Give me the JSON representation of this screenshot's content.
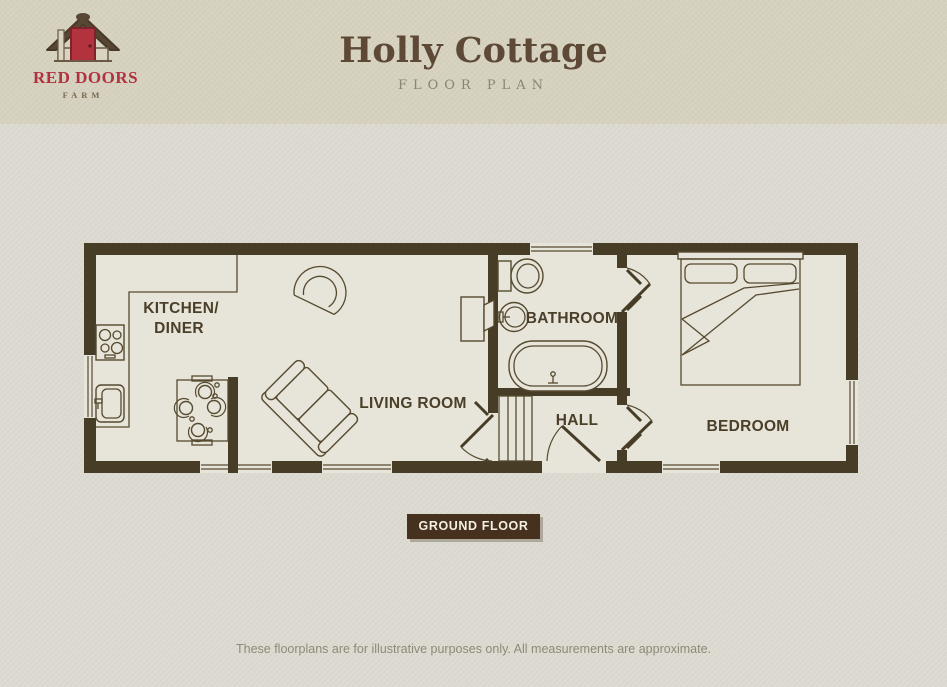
{
  "page": {
    "background": "#dcdad1"
  },
  "header": {
    "background": "#d6d2bf",
    "logo": {
      "icon": "red-door-hut-icon",
      "title": "RED DOORS",
      "subtitle": "FARM",
      "accent_red": "#b13140",
      "roof_brown": "#574633"
    },
    "title": "Holly Cottage",
    "subtitle": "FLOOR PLAN",
    "title_color": "#5e4936",
    "subtitle_color": "#8b8471"
  },
  "plan": {
    "wall_color": "#473d27",
    "room_fill": "#e7e4d9",
    "line_color": "#564a30",
    "labels": {
      "kitchen_line1": "KITCHEN/",
      "kitchen_line2": "DINER",
      "living": "LIVING ROOM",
      "bathroom": "BATHROOM",
      "hall": "HALL",
      "bedroom": "BEDROOM"
    },
    "fixtures": [
      "hob-icon",
      "kitchen-sink-icon",
      "kitchen-counter",
      "dining-table-icon",
      "tub-chair-icon",
      "sofa-icon",
      "stove-icon",
      "toilet-icon",
      "wash-basin-icon",
      "bathtub-icon",
      "hall-cupboard-icon",
      "double-bed-icon"
    ],
    "floor_badge": "GROUND FLOOR",
    "badge_bg": "#45311d",
    "badge_text_color": "#f4f0e4"
  },
  "footer": {
    "disclaimer": "These floorplans are for illustrative purposes only. All measurements are approximate."
  }
}
